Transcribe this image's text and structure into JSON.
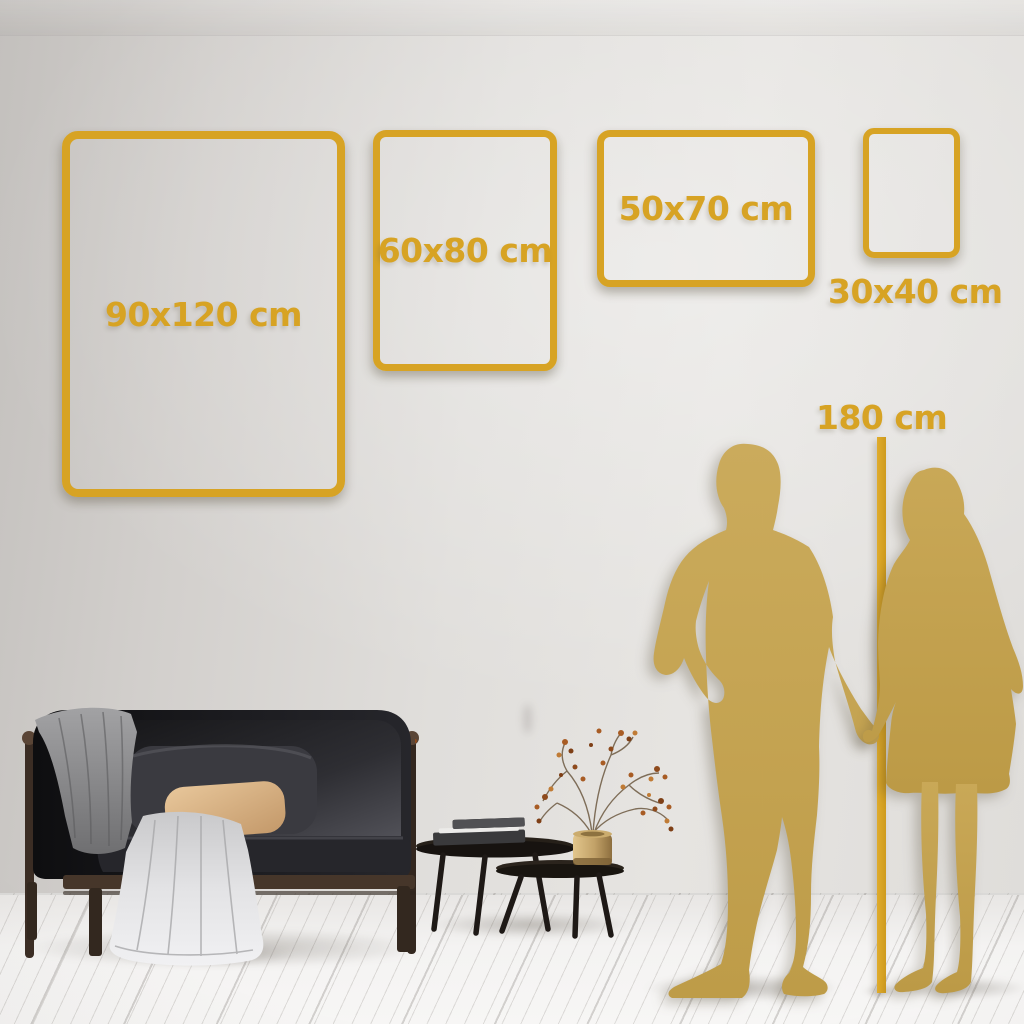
{
  "meta": {
    "description": "Poster size guide mockup: gold outline frames on a living-room wall with couple silhouettes for scale"
  },
  "accent_colors": {
    "frame_gold": "#D7A324",
    "line_gold": "#CE9A1D",
    "silhouette_gold": "#C5A351"
  },
  "size_frames": [
    {
      "label": "90x120 cm",
      "orientation": "portrait",
      "label_position": "inside"
    },
    {
      "label": "60x80 cm",
      "orientation": "portrait",
      "label_position": "inside"
    },
    {
      "label": "50x70 cm",
      "orientation": "landscape",
      "label_position": "inside"
    },
    {
      "label": "30x40 cm",
      "orientation": "portrait",
      "label_position": "below"
    }
  ],
  "height_reference": {
    "label": "180 cm"
  },
  "scene": {
    "objects": [
      "dark-velvet-sofa",
      "grey-throw-blanket",
      "draped-light-blanket",
      "tan-pillow",
      "grey-pillow",
      "nesting-coffee-tables",
      "stacked-books",
      "brass-vase",
      "dried-berry-plant",
      "man-silhouette",
      "woman-silhouette",
      "height-reference-line",
      "white-plank-floor"
    ]
  }
}
